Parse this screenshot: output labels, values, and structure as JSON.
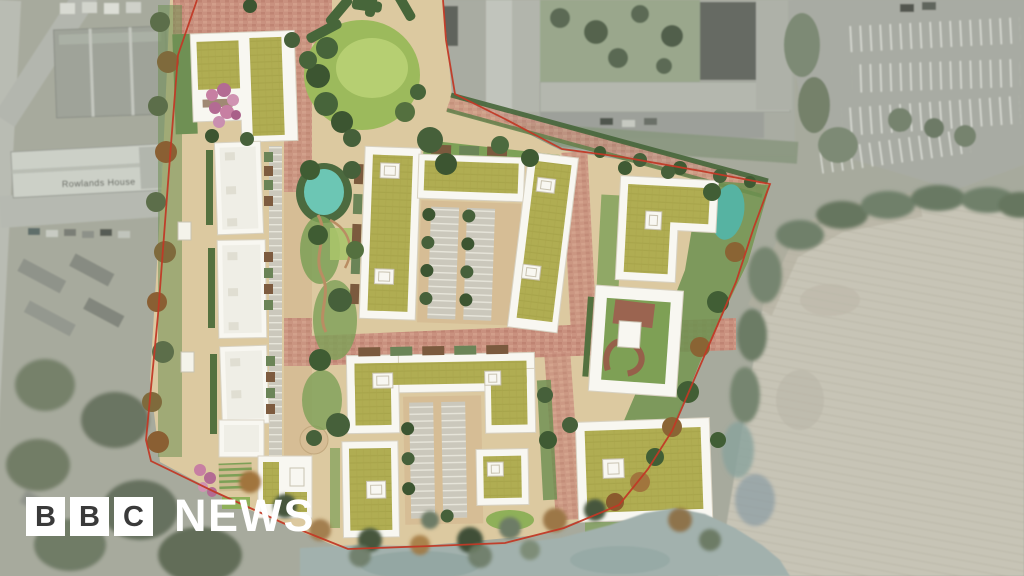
{
  "image": {
    "type": "aerial-architectural-masterplan",
    "description": "Aerial CGI masterplan of a proposed housing development shown in colour over a desaturated aerial photograph of surrounding streets, an institutional building with car park, and a ploughed field"
  },
  "aerial": {
    "rowlands_house_label": "Rowlands House"
  },
  "logo": {
    "blocks": [
      "B",
      "B",
      "C"
    ],
    "wordmark": "NEWS"
  },
  "colors": {
    "aerial_base": "#a7aa9d",
    "aerial_road": "#b9bcb3",
    "field": "#c7c4b6",
    "plan_base": "#dcc9a0",
    "brick_road": "#c9917f",
    "tan_path": "#d6bd95",
    "lawn": "#9dbb5d",
    "hedge": "#54713f",
    "tree_dark": "#3c5531",
    "tree_autumn": "#a1753d",
    "pond": "#6cc6b4",
    "water_desaturated": "#a2b1ad",
    "building_white": "#f8f7f1",
    "sedum_roof": "#b0ad52",
    "boundary_red": "#c13926",
    "logo_block_bg": "#ffffff",
    "logo_block_text": "#3a3a3a",
    "logo_wordmark": "#ffffff"
  }
}
